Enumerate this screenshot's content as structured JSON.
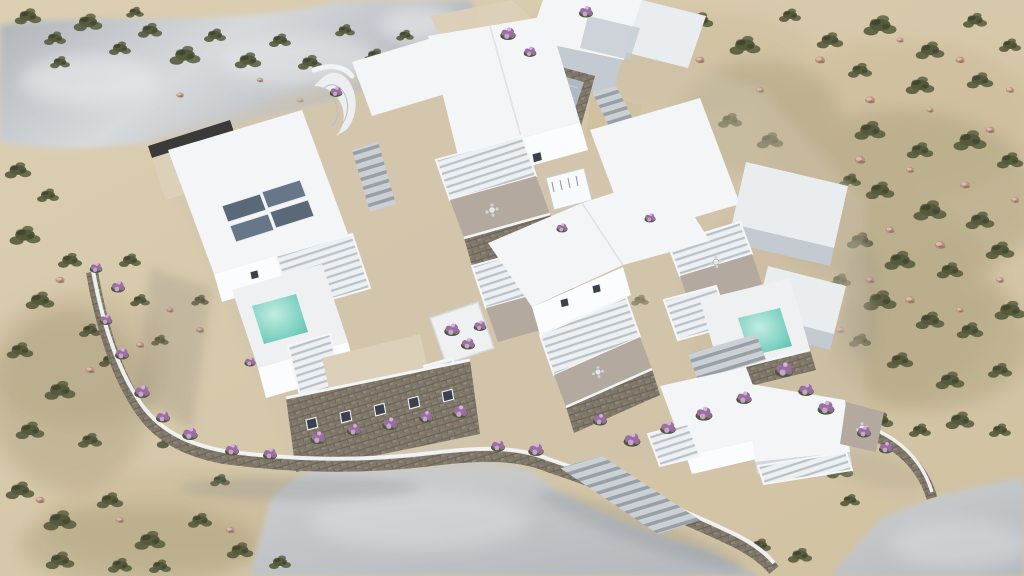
{
  "meta": {
    "type": "aerial-3d-architectural-render",
    "subject": "whitewashed Cycladic villa complex on a sandy scrub hillside",
    "view": "high-angle axonometric aerial"
  },
  "palette": {
    "sandLight": "#dccfb2",
    "sandMid": "#d0c1a1",
    "sandShade": "#bfae8d",
    "bandLight": "#d7dadd",
    "bandDark": "#adb2b8",
    "apronLight": "#d0d3d5",
    "apronDark": "#b6babe",
    "roofWhite": "#f3f5f6",
    "roofShaded": "#e9edf0",
    "wallLit": "#fbfcfd",
    "wallShade": "#d2d8de",
    "wallShade2": "#c3cad2",
    "deckWhite": "#eef0f1",
    "cream": "#dcd0b8",
    "terrace": "#b3a99e",
    "stoneBase": "#7f7769",
    "stoneDark": "#5f594e",
    "courtFloor": "#aeb9c3",
    "poolLight": "#c2ece2",
    "pool": "#7fd2c2",
    "poolDeep": "#56b8a9",
    "solar": "#5a6878",
    "shrub": "#555a3c",
    "rockStone": "#bb9180",
    "flower": "#9a6fa2",
    "leaf": "#4c5a38",
    "windowDark": "#39414d",
    "shadow": "#8f897c"
  },
  "scene": {
    "terrain": {
      "ground": "sand with low olive scrub and scattered stones",
      "rock_outcrop": "grey rock band across upper left",
      "aprons": "grey stone ground at lower center and lower right corner"
    },
    "complex": {
      "villas": 6,
      "pools": 2,
      "solar_panels": 4,
      "sunken_courtyard": 1,
      "pergola_canopies": 10,
      "staircases": 4,
      "cabanas": 2,
      "stone_retaining_walls": "dry-stone with white caps",
      "planting": "purple bougainvillea beds along walls"
    }
  },
  "scatter": {
    "shrubs": [
      [
        28,
        16,
        1.2
      ],
      [
        55,
        38,
        1.0
      ],
      [
        88,
        22,
        1.3
      ],
      [
        120,
        48,
        1.0
      ],
      [
        150,
        30,
        1.1
      ],
      [
        185,
        55,
        1.4
      ],
      [
        215,
        35,
        1.0
      ],
      [
        248,
        60,
        1.2
      ],
      [
        280,
        40,
        1.0
      ],
      [
        310,
        62,
        1.1
      ],
      [
        345,
        30,
        0.9
      ],
      [
        375,
        55,
        1.0
      ],
      [
        405,
        35,
        0.8
      ],
      [
        60,
        62,
        0.9
      ],
      [
        135,
        12,
        0.8
      ],
      [
        18,
        170,
        1.2
      ],
      [
        48,
        195,
        1.0
      ],
      [
        25,
        235,
        1.4
      ],
      [
        70,
        260,
        1.1
      ],
      [
        40,
        300,
        1.3
      ],
      [
        90,
        330,
        1.0
      ],
      [
        20,
        350,
        1.2
      ],
      [
        60,
        390,
        1.4
      ],
      [
        110,
        360,
        1.0
      ],
      [
        30,
        430,
        1.3
      ],
      [
        90,
        440,
        1.1
      ],
      [
        140,
        300,
        0.9
      ],
      [
        160,
        340,
        0.8
      ],
      [
        130,
        260,
        1.0
      ],
      [
        170,
        440,
        1.2
      ],
      [
        200,
        300,
        0.8
      ],
      [
        20,
        490,
        1.3
      ],
      [
        60,
        520,
        1.5
      ],
      [
        110,
        500,
        1.2
      ],
      [
        150,
        540,
        1.4
      ],
      [
        200,
        520,
        1.1
      ],
      [
        60,
        560,
        1.3
      ],
      [
        160,
        566,
        1.0
      ],
      [
        240,
        550,
        1.2
      ],
      [
        280,
        562,
        1.0
      ],
      [
        220,
        480,
        0.9
      ],
      [
        120,
        565,
        1.1
      ],
      [
        660,
        40,
        1.0
      ],
      [
        700,
        20,
        1.2
      ],
      [
        745,
        45,
        1.4
      ],
      [
        790,
        15,
        1.0
      ],
      [
        830,
        40,
        1.2
      ],
      [
        880,
        25,
        1.5
      ],
      [
        930,
        50,
        1.3
      ],
      [
        975,
        20,
        1.1
      ],
      [
        1010,
        45,
        1.0
      ],
      [
        860,
        70,
        1.1
      ],
      [
        920,
        85,
        1.3
      ],
      [
        980,
        80,
        1.2
      ],
      [
        650,
        120,
        1.0
      ],
      [
        690,
        150,
        1.3
      ],
      [
        730,
        120,
        1.1
      ],
      [
        770,
        140,
        1.2
      ],
      [
        870,
        130,
        1.4
      ],
      [
        920,
        150,
        1.2
      ],
      [
        970,
        140,
        1.5
      ],
      [
        1010,
        160,
        1.2
      ],
      [
        880,
        190,
        1.3
      ],
      [
        930,
        210,
        1.5
      ],
      [
        980,
        220,
        1.3
      ],
      [
        860,
        240,
        1.2
      ],
      [
        900,
        260,
        1.4
      ],
      [
        950,
        270,
        1.2
      ],
      [
        1000,
        250,
        1.3
      ],
      [
        880,
        300,
        1.5
      ],
      [
        930,
        320,
        1.3
      ],
      [
        970,
        330,
        1.2
      ],
      [
        1010,
        310,
        1.4
      ],
      [
        900,
        360,
        1.2
      ],
      [
        950,
        380,
        1.3
      ],
      [
        1000,
        370,
        1.1
      ],
      [
        860,
        340,
        1.0
      ],
      [
        840,
        280,
        1.0
      ],
      [
        820,
        230,
        0.9
      ],
      [
        850,
        180,
        1.0
      ],
      [
        880,
        420,
        1.2
      ],
      [
        920,
        430,
        1.0
      ],
      [
        960,
        420,
        1.3
      ],
      [
        1000,
        430,
        1.0
      ],
      [
        800,
        460,
        1.0
      ],
      [
        840,
        470,
        1.2
      ],
      [
        760,
        545,
        1.0
      ],
      [
        800,
        555,
        1.1
      ],
      [
        850,
        500,
        0.9
      ],
      [
        210,
        150,
        0.9
      ],
      [
        260,
        140,
        0.8
      ],
      [
        300,
        130,
        0.8
      ],
      [
        430,
        90,
        0.7
      ],
      [
        470,
        60,
        0.8
      ],
      [
        610,
        120,
        0.8
      ],
      [
        630,
        160,
        0.9
      ],
      [
        610,
        250,
        0.8
      ],
      [
        640,
        300,
        0.8
      ],
      [
        620,
        340,
        0.9
      ]
    ],
    "rocks": [
      [
        700,
        60,
        1.0
      ],
      [
        760,
        90,
        0.9
      ],
      [
        820,
        60,
        1.1
      ],
      [
        900,
        40,
        0.8
      ],
      [
        960,
        60,
        1.0
      ],
      [
        1010,
        90,
        0.9
      ],
      [
        870,
        100,
        1.1
      ],
      [
        930,
        110,
        0.8
      ],
      [
        990,
        130,
        1.0
      ],
      [
        860,
        160,
        1.2
      ],
      [
        910,
        170,
        0.9
      ],
      [
        965,
        185,
        1.1
      ],
      [
        1015,
        200,
        0.9
      ],
      [
        890,
        230,
        1.0
      ],
      [
        940,
        245,
        1.2
      ],
      [
        1000,
        280,
        0.9
      ],
      [
        870,
        280,
        1.0
      ],
      [
        910,
        300,
        1.1
      ],
      [
        960,
        310,
        0.8
      ],
      [
        840,
        330,
        1.0
      ],
      [
        60,
        280,
        1.0
      ],
      [
        100,
        310,
        1.1
      ],
      [
        140,
        345,
        0.9
      ],
      [
        90,
        370,
        1.0
      ],
      [
        170,
        310,
        0.8
      ],
      [
        200,
        330,
        0.9
      ],
      [
        40,
        500,
        1.0
      ],
      [
        120,
        520,
        0.9
      ],
      [
        230,
        530,
        1.0
      ],
      [
        300,
        100,
        0.8
      ],
      [
        260,
        80,
        0.7
      ],
      [
        180,
        95,
        0.8
      ]
    ],
    "flowers": [
      [
        318,
        438,
        1.1
      ],
      [
        354,
        430,
        1.0
      ],
      [
        390,
        424,
        1.1
      ],
      [
        426,
        417,
        1.0
      ],
      [
        460,
        412,
        1.1
      ],
      [
        498,
        446,
        1.0
      ],
      [
        536,
        450,
        1.1
      ],
      [
        118,
        287,
        1.0
      ],
      [
        106,
        320,
        0.9
      ],
      [
        122,
        354,
        1.0
      ],
      [
        142,
        392,
        1.1
      ],
      [
        163,
        417,
        1.0
      ],
      [
        190,
        434,
        1.1
      ],
      [
        232,
        450,
        1.0
      ],
      [
        270,
        454,
        1.0
      ],
      [
        508,
        34,
        1.1
      ],
      [
        530,
        52,
        0.9
      ],
      [
        586,
        12,
        1.0
      ],
      [
        632,
        440,
        1.2
      ],
      [
        668,
        428,
        1.1
      ],
      [
        704,
        414,
        1.2
      ],
      [
        744,
        398,
        1.1
      ],
      [
        784,
        370,
        1.3
      ],
      [
        806,
        390,
        1.1
      ],
      [
        826,
        408,
        1.2
      ],
      [
        864,
        432,
        1.0
      ],
      [
        886,
        448,
        1.0
      ],
      [
        452,
        330,
        1.1
      ],
      [
        468,
        344,
        1.0
      ],
      [
        480,
        326,
        0.9
      ],
      [
        562,
        228,
        0.8
      ],
      [
        650,
        218,
        0.8
      ],
      [
        600,
        420,
        1.0
      ],
      [
        250,
        362,
        0.8
      ],
      [
        96,
        268,
        0.9
      ],
      [
        336,
        92,
        0.9
      ]
    ]
  }
}
